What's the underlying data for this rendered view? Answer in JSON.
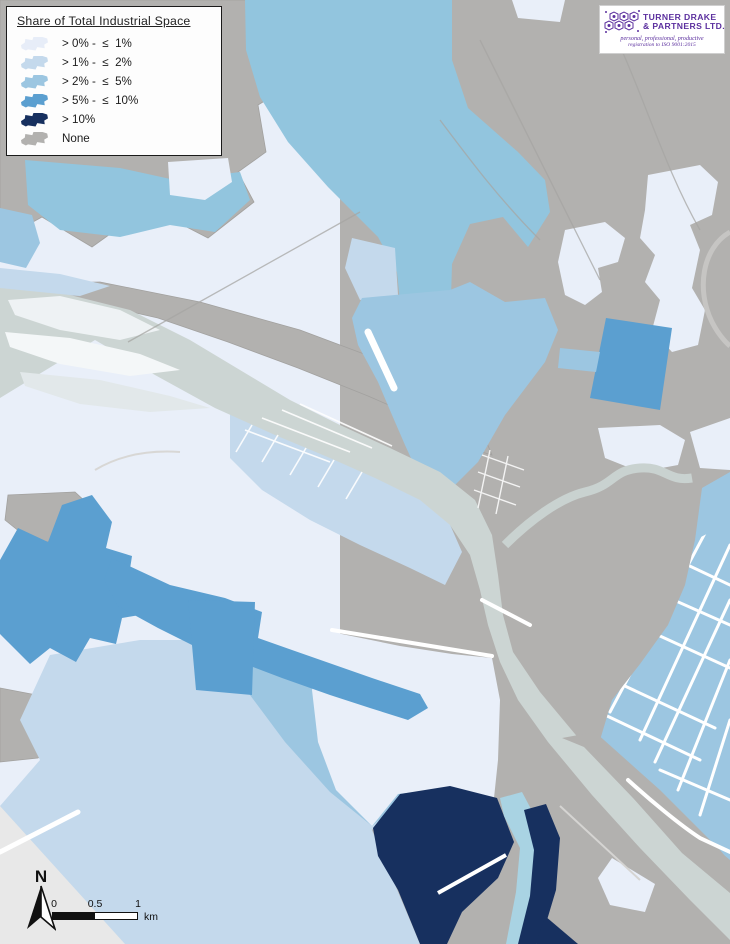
{
  "legend": {
    "title": "Share of Total Industrial Space",
    "items": [
      {
        "label": "> 0% -  ≤  1%",
        "color": "#e7edf8"
      },
      {
        "label": "> 1% -  ≤  2%",
        "color": "#c4d9ec"
      },
      {
        "label": "> 2% -  ≤  5%",
        "color": "#9cc6e1"
      },
      {
        "label": "> 5% -  ≤  10%",
        "color": "#5b9fd0"
      },
      {
        "label": "> 10%",
        "color": "#17305f"
      },
      {
        "label": "None",
        "color": "#b2b1af"
      }
    ]
  },
  "logo": {
    "name_line1": "TURNER DRAKE",
    "name_line2": "& PARTNERS LTD.",
    "tagline": "personal, professional, productive",
    "registration": "registration to ISO 9001:2015",
    "brand_color": "#5b2f9e"
  },
  "north_arrow": {
    "label": "N"
  },
  "scale_bar": {
    "labels": [
      "0",
      "0.5",
      "1"
    ],
    "unit": "km"
  },
  "map_colors": {
    "share_0_1": "#e9eff9",
    "share_1_2": "#c4d9ec",
    "share_2_5": "#9cc6e1",
    "share_5_10": "#5b9fd0",
    "share_gt10": "#17305f",
    "none": "#b2b1af",
    "water": "#92c5de",
    "river": "#ccd5d3",
    "falls": "#a9d3e3",
    "light_wedge": "#e8e8e8",
    "road": "#ffffff"
  }
}
